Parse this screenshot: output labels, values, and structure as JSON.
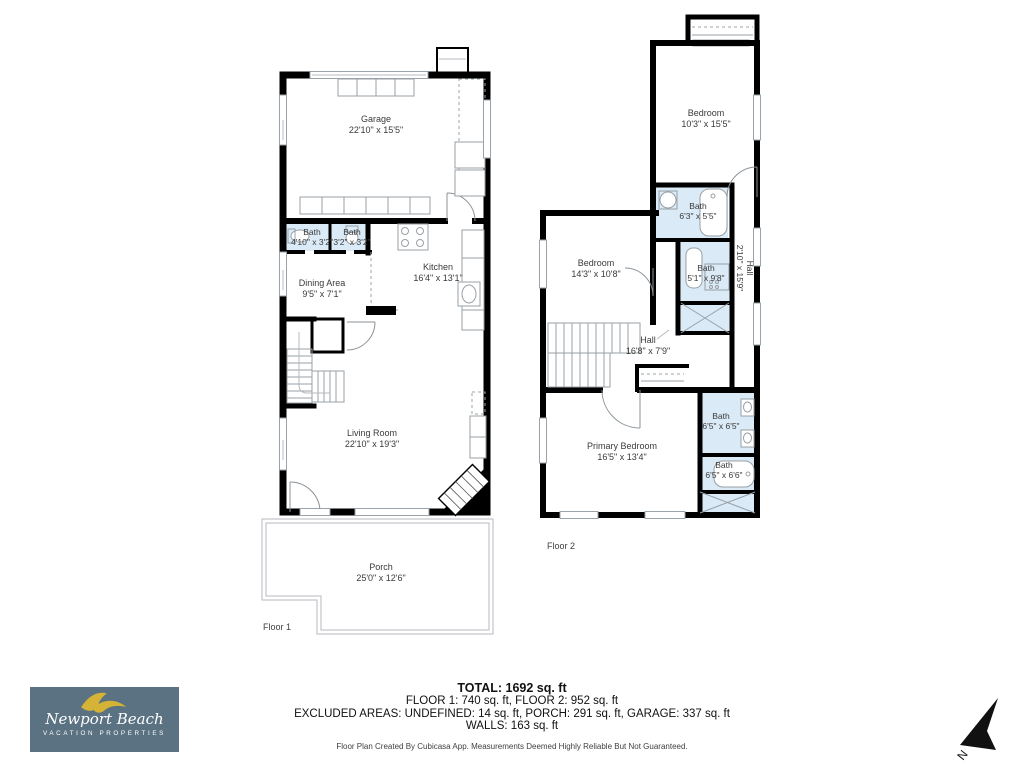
{
  "floor1": {
    "label": "Floor 1",
    "rooms": {
      "garage": {
        "name": "Garage",
        "dims": "22'10\" x 15'5\""
      },
      "bath_left": {
        "name": "Bath",
        "dims": "4'10\" x 3'2\""
      },
      "bath_right": {
        "name": "Bath",
        "dims": "3'2\" x 3'2\""
      },
      "dining": {
        "name": "Dining Area",
        "dims": "9'5\" x 7'1\""
      },
      "kitchen": {
        "name": "Kitchen",
        "dims": "16'4\" x 13'1\""
      },
      "living": {
        "name": "Living Room",
        "dims": "22'10\" x 19'3\""
      },
      "porch": {
        "name": "Porch",
        "dims": "25'0\" x 12'6\""
      }
    }
  },
  "floor2": {
    "label": "Floor 2",
    "rooms": {
      "bedroom_top": {
        "name": "Bedroom",
        "dims": "10'3\" x 15'5\""
      },
      "bath_top": {
        "name": "Bath",
        "dims": "6'3\" x 5'5\""
      },
      "bedroom_mid": {
        "name": "Bedroom",
        "dims": "14'3\" x 10'8\""
      },
      "bath_mid": {
        "name": "Bath",
        "dims": "5'1\" x 9'8\""
      },
      "hall": {
        "name": "Hall",
        "dims": "16'8\" x 7'9\""
      },
      "hall_side": {
        "name": "Hall",
        "dims": "2'10\" x 15'9\""
      },
      "primary": {
        "name": "Primary Bedroom",
        "dims": "16'5\" x 13'4\""
      },
      "bath_primary_1": {
        "name": "Bath",
        "dims": "6'5\" x 6'5\""
      },
      "bath_primary_2": {
        "name": "Bath",
        "dims": "6'5\" x 6'6\""
      }
    }
  },
  "summary": {
    "total": "TOTAL: 1692 sq. ft",
    "floors": "FLOOR 1: 740 sq. ft, FLOOR 2: 952 sq. ft",
    "excluded": "EXCLUDED AREAS: UNDEFINED: 14 sq. ft, PORCH: 291 sq. ft, GARAGE: 337 sq. ft",
    "walls": "WALLS: 163 sq. ft",
    "disclaimer": "Floor Plan Created By Cubicasa App. Measurements Deemed Highly Reliable But Not Guaranteed."
  },
  "logo": {
    "line1": "Newport Beach",
    "line2": "VACATION PROPERTIES",
    "bg_color": "#5b7282",
    "bird_color": "#d5b336",
    "text_color": "#ffffff"
  },
  "compass": {
    "label": "N"
  },
  "colors": {
    "wall": "#000000",
    "bath_fill": "#daeaf6",
    "label_text": "#3a3a3a"
  }
}
